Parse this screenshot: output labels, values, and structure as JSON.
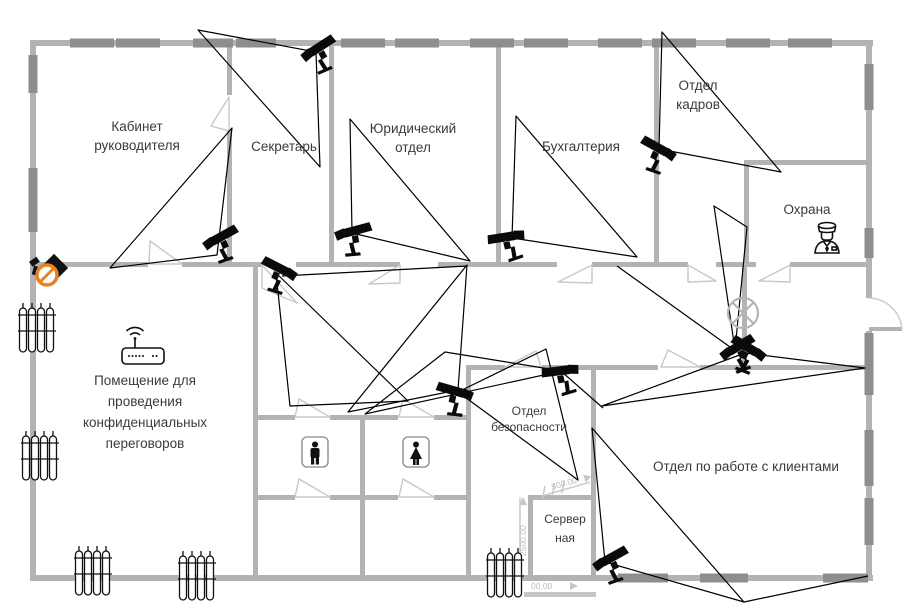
{
  "meta": {
    "type": "floor-plan",
    "language": "ru",
    "description": "Office floor plan with CCTV cameras and coverage zones"
  },
  "rooms": {
    "director": {
      "lines": [
        "Кабинет",
        "руководителя"
      ]
    },
    "secretary": {
      "lines": [
        "Секретарь"
      ]
    },
    "legal": {
      "lines": [
        "Юридический",
        "отдел"
      ]
    },
    "accounting": {
      "lines": [
        "Бухгалтерия"
      ]
    },
    "hr": {
      "lines": [
        "Отдел",
        "кадров"
      ]
    },
    "guard_post": {
      "lines": [
        "Охрана"
      ]
    },
    "negotiations": {
      "lines": [
        "Помещение для",
        "проведения",
        "конфиденциальных",
        "переговоров"
      ]
    },
    "security": {
      "lines": [
        "Отдел",
        "безопасности"
      ]
    },
    "clients": {
      "lines": [
        "Отдел по работе с клиентами"
      ]
    },
    "server": {
      "lines": [
        "Сервер",
        "ная"
      ]
    }
  },
  "dimensions": {
    "vertical": "2500.00",
    "horizontal": "00.00",
    "server_top": "500.00"
  },
  "icons": {
    "camera": "cctv-camera",
    "no_entry": "no-camera-sign",
    "wifi": "wifi-router",
    "guard": "security-guard",
    "lamp": "ceiling-lamp",
    "wc_male": "male-wc",
    "wc_female": "female-wc",
    "radiator": "radiator"
  },
  "colors": {
    "wall": "#b3b3b3",
    "window": "#8e8e8e",
    "door": "#c8c8c8",
    "fov_line": "#000000",
    "dimension": "#c6c6c6",
    "no_entry_orange": "#e8821e",
    "icon_black": "#111111",
    "label_text": "#3b3b3b"
  },
  "cameras": [
    {
      "id": "cam-secretary-wall",
      "x": 315,
      "y": 52,
      "rot": 12,
      "mirror": true
    },
    {
      "id": "cam-director",
      "x": 217,
      "y": 241,
      "rot": 8,
      "mirror": true
    },
    {
      "id": "cam-legal",
      "x": 349,
      "y": 234,
      "rot": -6,
      "mirror": true
    },
    {
      "id": "cam-accounting",
      "x": 511,
      "y": 238,
      "rot": -30,
      "mirror": false
    },
    {
      "id": "cam-hr",
      "x": 662,
      "y": 152,
      "rot": 8,
      "mirror": false
    },
    {
      "id": "cam-corridor",
      "x": 283,
      "y": 272,
      "rot": 6,
      "mirror": false
    },
    {
      "id": "cam-security-west",
      "x": 459,
      "y": 394,
      "rot": -5,
      "mirror": false
    },
    {
      "id": "cam-security-north",
      "x": 565,
      "y": 372,
      "rot": -28,
      "mirror": false
    },
    {
      "id": "cam-hall-left",
      "x": 734,
      "y": 351,
      "rot": 10,
      "mirror": true
    },
    {
      "id": "cam-hall-right",
      "x": 752,
      "y": 352,
      "rot": 10,
      "mirror": false
    },
    {
      "id": "cam-clients",
      "x": 607,
      "y": 562,
      "rot": 8,
      "mirror": true
    }
  ],
  "fov": {
    "polygons": [
      [
        [
          198,
          30
        ],
        [
          316,
          52
        ],
        [
          320,
          167
        ]
      ],
      [
        [
          232,
          128
        ],
        [
          110,
          268
        ],
        [
          217,
          255
        ]
      ],
      [
        [
          350,
          119
        ],
        [
          352,
          233
        ],
        [
          470,
          261
        ]
      ],
      [
        [
          516,
          116
        ],
        [
          512,
          238
        ],
        [
          637,
          257
        ]
      ],
      [
        [
          662,
          32
        ],
        [
          659,
          149
        ],
        [
          781,
          172
        ]
      ],
      [
        [
          276,
          273
        ],
        [
          290,
          406
        ],
        [
          408,
          401
        ]
      ],
      [
        [
          458,
          390
        ],
        [
          467,
          265
        ],
        [
          348,
          412
        ]
      ],
      [
        [
          458,
          392
        ],
        [
          546,
          349
        ],
        [
          578,
          480
        ]
      ],
      [
        [
          562,
          371
        ],
        [
          445,
          352
        ],
        [
          365,
          414
        ]
      ],
      [
        [
          735,
          350
        ],
        [
          714,
          206
        ],
        [
          747,
          227
        ]
      ],
      [
        [
          745,
          353
        ],
        [
          602,
          406
        ],
        [
          865,
          368
        ]
      ],
      [
        [
          605,
          562
        ],
        [
          592,
          428
        ],
        [
          744,
          602
        ]
      ]
    ],
    "segments": [
      [
        [
          282,
          276
        ],
        [
          467,
          266
        ]
      ],
      [
        [
          562,
          372
        ],
        [
          603,
          408
        ]
      ],
      [
        [
          744,
          602
        ],
        [
          868,
          576
        ]
      ],
      [
        [
          730,
          347
        ],
        [
          617,
          266
        ]
      ]
    ]
  },
  "radiators": [
    {
      "x": 18,
      "y": 303
    },
    {
      "x": 21,
      "y": 431
    },
    {
      "x": 74,
      "y": 546
    },
    {
      "x": 178,
      "y": 551
    },
    {
      "x": 486,
      "y": 548
    }
  ]
}
